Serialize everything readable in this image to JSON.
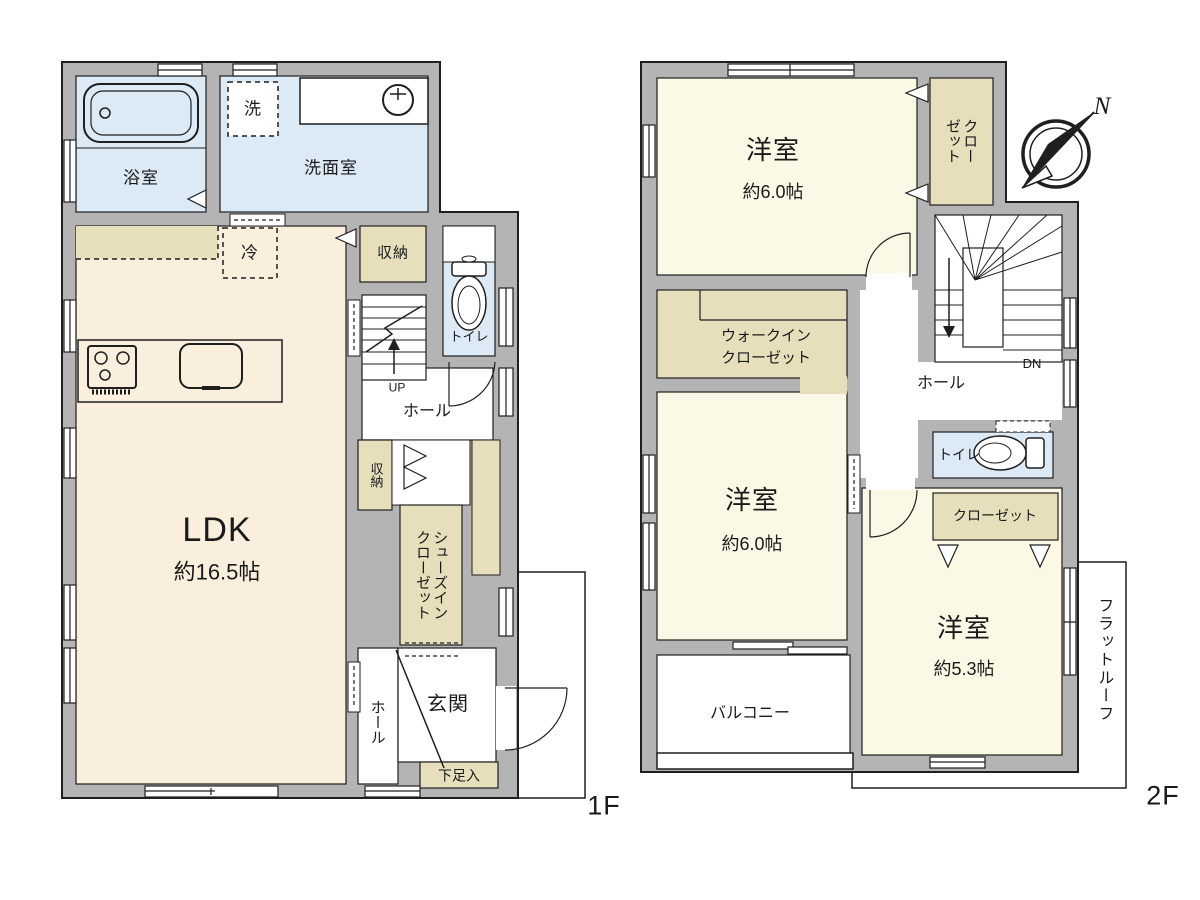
{
  "plan": {
    "type": "floor-plan",
    "colors": {
      "wall_fill": "#b4b4b4",
      "outline": "#1f1f1f",
      "water_room": "#dceaf6",
      "room_1f": "#faefdd",
      "room_2f": "#fcf8e6",
      "closet": "#e7dfbc",
      "background": "#ffffff"
    }
  },
  "f1": {
    "floor_label": "1F",
    "bath": "浴室",
    "washer": "洗",
    "powder_room": "洗面室",
    "fridge": "冷",
    "storage_top": "収納",
    "toilet": "トイレ",
    "stairs_up": "UP",
    "hall": "ホール",
    "storage_mid": "収納",
    "ldk_name": "LDK",
    "ldk_size": "約16.5帖",
    "sic_line1": "シューズイン",
    "sic_line2": "クローゼット",
    "hall2": "ホール",
    "entrance": "玄関",
    "shoe_box": "下足入"
  },
  "f2": {
    "floor_label": "2F",
    "compass_north": "N",
    "bedroom1_name": "洋室",
    "bedroom1_size": "約6.0帖",
    "closet1_line1": "クロー",
    "closet1_line2": "ゼット",
    "stairs_down": "DN",
    "wic_line1": "ウォークイン",
    "wic_line2": "クローゼット",
    "hall": "ホール",
    "bedroom2_name": "洋室",
    "bedroom2_size": "約6.0帖",
    "toilet": "トイレ",
    "closet2": "クローゼット",
    "bedroom3_name": "洋室",
    "bedroom3_size": "約5.3帖",
    "balcony": "バルコニー",
    "flat_roof": "フラットルーフ"
  }
}
